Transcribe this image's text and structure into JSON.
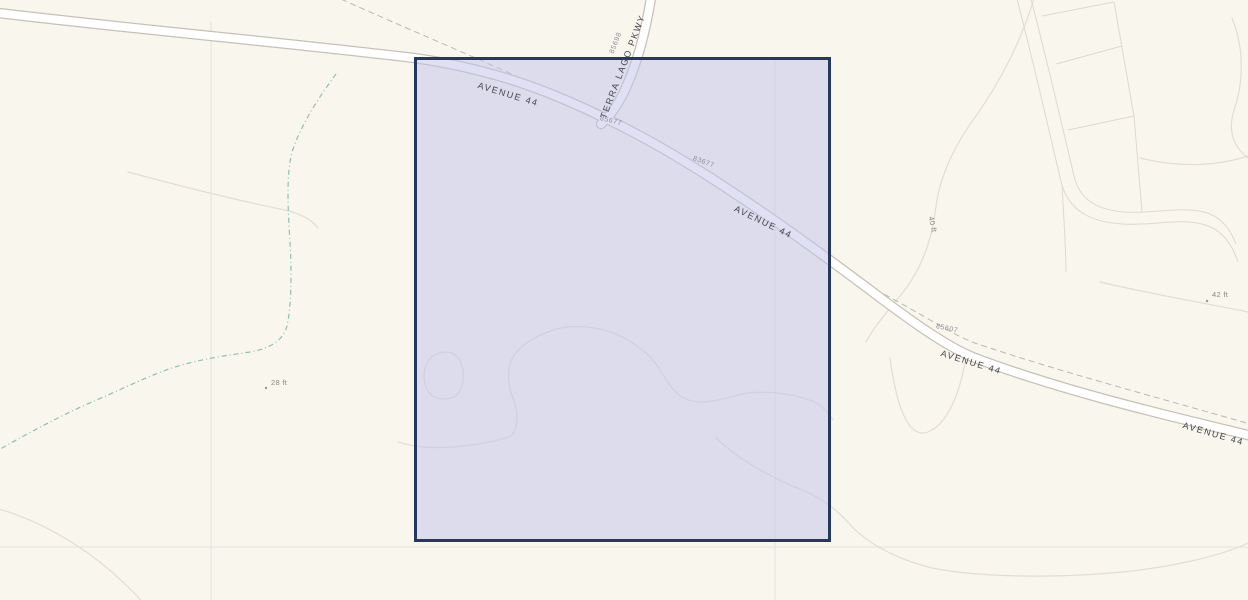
{
  "map": {
    "type": "gis-parcel-viewer",
    "background_color": "#f9f6ee",
    "selected_parcel": {
      "fill_color": "#c2c2ea",
      "border_color": "#24395e"
    },
    "road_color": "#ffffff",
    "road_casing_color": "#c6c1b6",
    "contour_color": "#e3ddd1",
    "stream_color": "#8fbfae"
  },
  "labels": [
    {
      "id": "road-avenue44-west",
      "text": "AVENUE 44"
    },
    {
      "id": "road-terra-lago-pkwy",
      "text": "TERRA LAGO PKWY"
    },
    {
      "id": "addr-85698",
      "text": "85698"
    },
    {
      "id": "addr-85677",
      "text": "85677"
    },
    {
      "id": "addr-83677",
      "text": "83677"
    },
    {
      "id": "road-avenue44-mid",
      "text": "AVENUE 44"
    },
    {
      "id": "addr-85607",
      "text": "85607"
    },
    {
      "id": "road-avenue44-east",
      "text": "AVENUE 44"
    },
    {
      "id": "road-avenue44-far",
      "text": "AVENUE 44"
    },
    {
      "id": "elev-28",
      "text": "28 ft"
    },
    {
      "id": "elev-42",
      "text": "42 ft"
    },
    {
      "id": "elev-40",
      "text": "40 ft"
    }
  ]
}
